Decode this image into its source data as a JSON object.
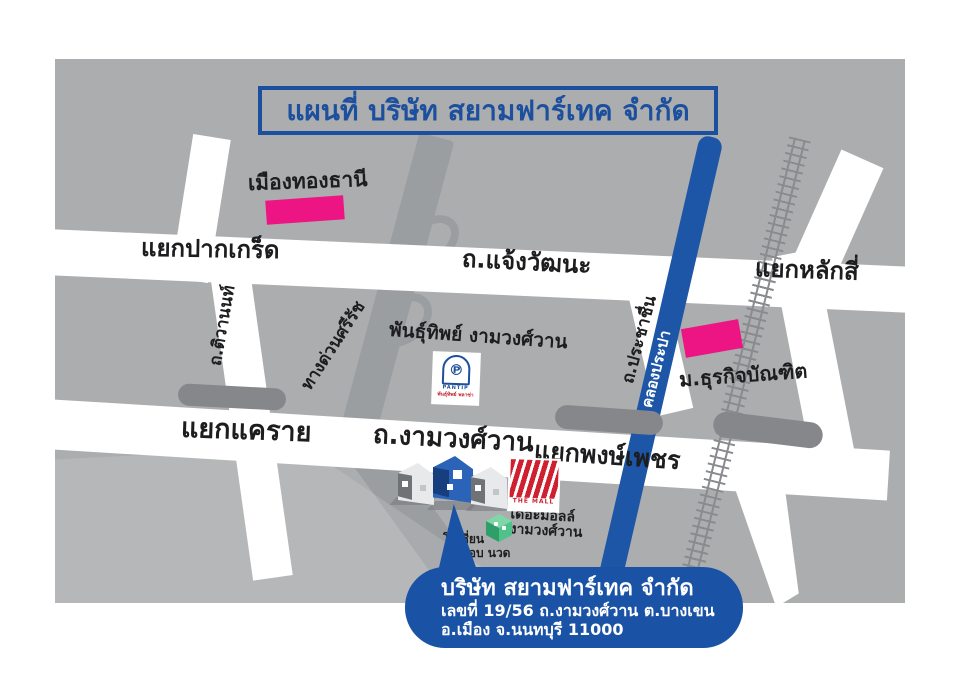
{
  "title": "แผนที่ บริษัท สยามฟาร์เทค จำกัด",
  "labels": {
    "muang_thong_thani": "เมืองทองธานี",
    "yaek_pak_kret": "แยกปากเกร็ด",
    "chaengwattana_rd": "ถ.แจ้งวัฒนะ",
    "yaek_lak_si": "แยกหลักสี่",
    "tiwanon_rd": "ถ.ติวานนท์",
    "si_rat_expressway": "ทางด่วนศรีรัช",
    "pantip_ngamwongwan": "พันธุ์ทิพย์ งามวงศ์วาน",
    "prachachuen_rd": "ถ.ประชาชื่น",
    "khlong_prapa": "คลองประปา",
    "dhurakij_pundit_university": "ม.ธุรกิจบัณฑิต",
    "yaek_khae_rai": "แยกแคราย",
    "ngamwongwan_rd": "ถ.งามวงศ์วาน",
    "yaek_phong_phet": "แยกพงษ์เพชร",
    "the_mall_line1": "เดอะมอลล์",
    "the_mall_line2": "งามวงศ์วาน",
    "ocean_line1": "โอเชี่ยน",
    "ocean_line2": "อาบ อบ นวด"
  },
  "logos": {
    "pantip": {
      "symbol": "℗",
      "name": "PANTIP",
      "sub": "พันธุ์ทิพย์ พลาซ่า"
    },
    "the_mall": {
      "name": "THE MALL"
    }
  },
  "callout": {
    "company": "บริษัท สยามฟาร์เทค จำกัด",
    "address_line1": "เลขที่ 19/56 ถ.งามวงศ์วาน ต.บางเขน",
    "address_line2": "อ.เมือง จ.นนทบุรี 11000"
  },
  "colors": {
    "map_background": "#abadaf",
    "road": "#ffffff",
    "expressway": "#9b9ea1",
    "overpass": "#85878a",
    "railway": "#898b8e",
    "canal_blue": "#1d56a7",
    "landmark_pink": "#ec1583",
    "title_blue": "#1c4f9d",
    "callout_blue": "#1a53a6",
    "mall_red": "#cf2030",
    "ocean_green": "#4fc28c"
  }
}
